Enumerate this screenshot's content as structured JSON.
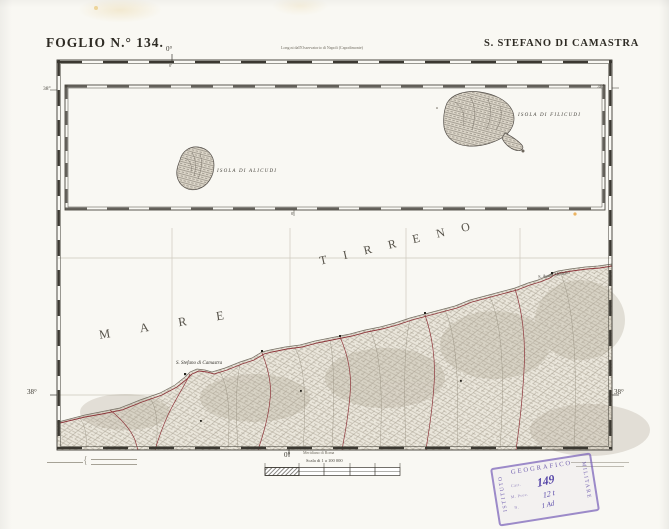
{
  "header": {
    "foglio": "FOGLIO N.° 134.",
    "title": "S. STEFANO DI CAMASTRA",
    "long_note": "Long.ni dall'Osservatorio di Napoli (Capodimonte)"
  },
  "graticule": {
    "top_lon": "0°",
    "top_lon_minor": "0'",
    "inset_lon": "0'",
    "bottom_lon": "0°",
    "lat_left_top": "38°",
    "lat_right_top": "38°",
    "lat_left_bottom": "38°",
    "lat_right_bottom": "38°"
  },
  "inset": {
    "island_left": "ISOLA DI ALICUDI",
    "island_right": "ISOLA DI FILICUDI"
  },
  "sea": {
    "word1": "MARE",
    "word2": "TIRRENO"
  },
  "places": {
    "town1": "S. Stefano di Camastra",
    "town2": "S. Agata Militello"
  },
  "footer": {
    "meridian_note": "Meridiano di Roma",
    "scale_text": "Scala di 1 a 100 000",
    "credit_brace": "{"
  },
  "stamp": {
    "top": "GEOGRAFICO",
    "left": "ISTITUTO",
    "right": "MILITARE",
    "row1": "Cart.",
    "row2": "M. Prov.",
    "row3": "N.",
    "hand1": "149",
    "hand2": "12 t",
    "hand3": "1 Ad"
  },
  "colors": {
    "paper": "#f7f5ef",
    "ink": "#3a372f",
    "road_red": "#8a2e34",
    "stamp_purple": "#765eb6"
  }
}
